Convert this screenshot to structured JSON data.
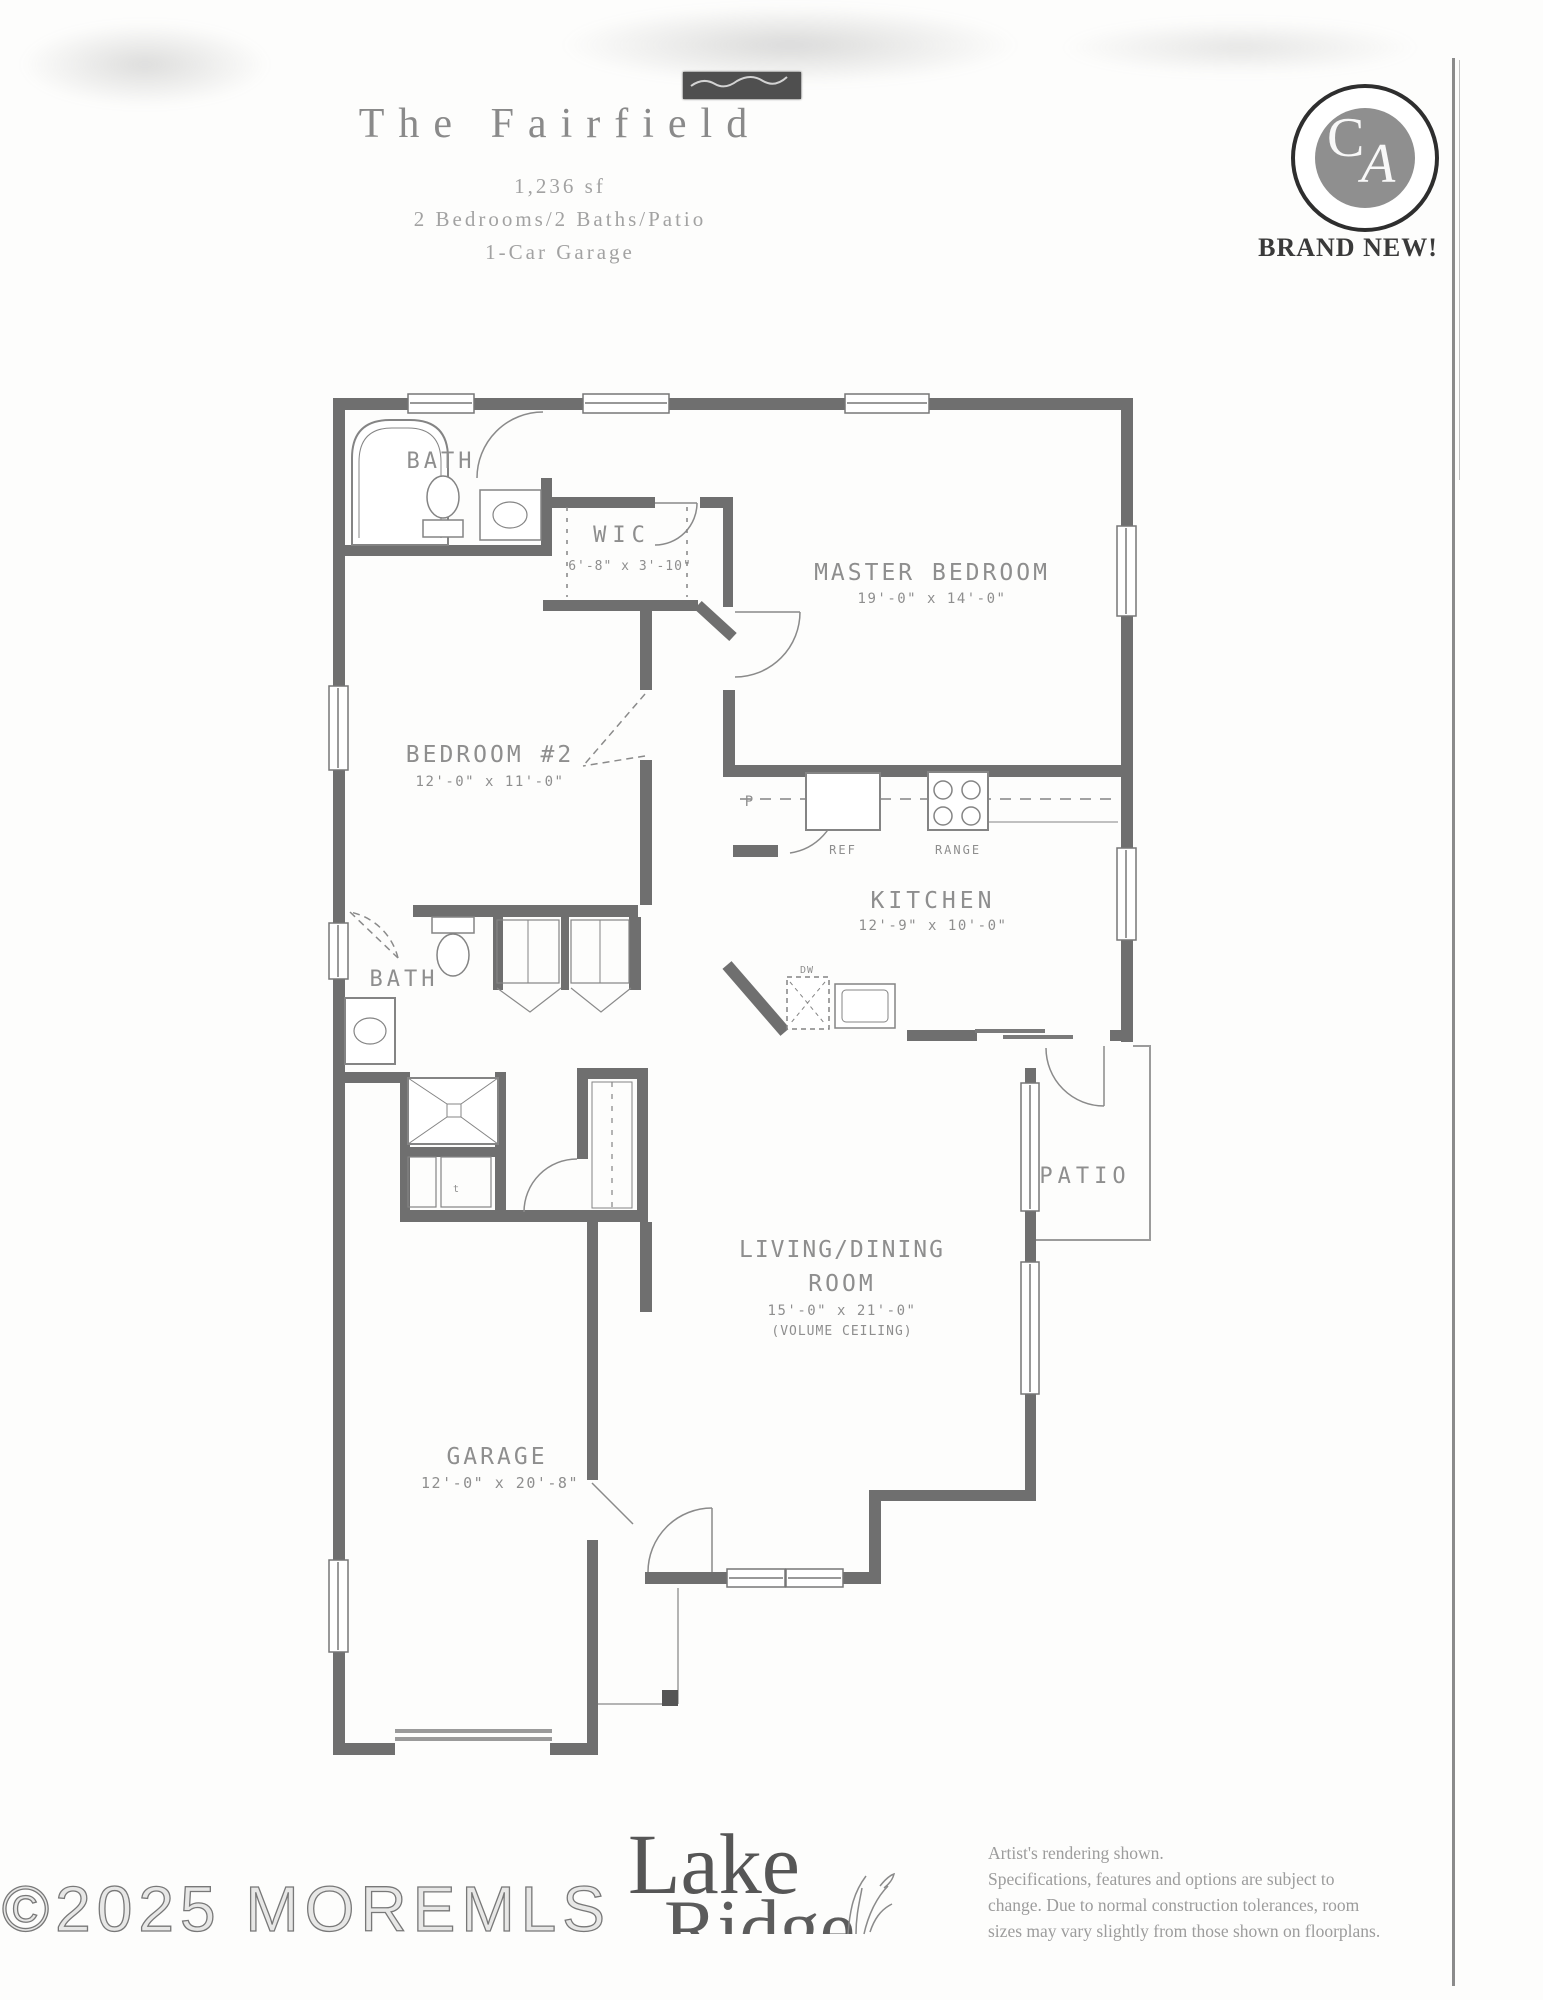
{
  "header": {
    "title": "The Fairfield",
    "subtitle_sqft": "1,236 sf",
    "subtitle_features": "2 Bedrooms/2 Baths/Patio",
    "subtitle_garage": "1-Car Garage"
  },
  "badge": {
    "monogram_c": "C",
    "monogram_a": "A",
    "label": "BRAND NEW!"
  },
  "floorplan": {
    "master_bedroom": {
      "name": "MASTER BEDROOM",
      "dims": "19'-0\" x 14'-0\""
    },
    "bedroom2": {
      "name": "BEDROOM #2",
      "dims": "12'-0\" x 11'-0\""
    },
    "kitchen": {
      "name": "KITCHEN",
      "dims": "12'-9\" x 10'-0\""
    },
    "living_dining": {
      "name": "LIVING/DINING",
      "name2": "ROOM",
      "dims": "15'-0\" x 21'-0\"",
      "note": "(VOLUME CEILING)"
    },
    "garage": {
      "name": "GARAGE",
      "dims": "12'-0\" x 20'-8\""
    },
    "wic": {
      "name": "WIC",
      "dims": "6'-8\" x 3'-10\""
    },
    "bath_master": "BATH",
    "bath_hall": "BATH",
    "patio": "PATIO",
    "pantry": "P",
    "refrigerator": "REF",
    "range": "RANGE",
    "dishwasher": "DW",
    "water_heater": "t"
  },
  "footer": {
    "builder_line1": "Lake",
    "builder_line2": "Ridge",
    "disclaimer": [
      "Artist's rendering shown.",
      "Specifications, features and options are subject to",
      "change. Due to normal construction tolerances, room",
      "sizes may vary slightly from those shown on floorplans."
    ],
    "watermark": "©2025 MOREMLS"
  }
}
